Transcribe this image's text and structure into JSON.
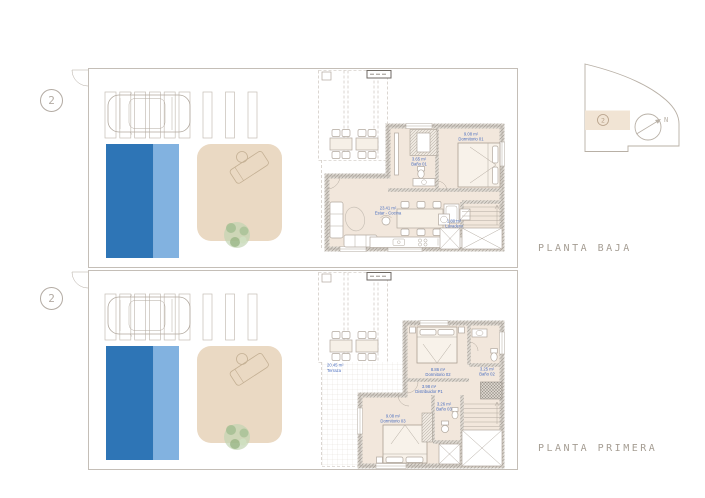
{
  "unit_number": "2",
  "titles": {
    "ground": "PLANTA BAJA",
    "first": "PLANTA PRIMERA"
  },
  "key_plan": {
    "unit_number": "2",
    "north_label": "N"
  },
  "colors": {
    "pool_dark": "#2e75b6",
    "pool_light": "#82b2e0",
    "patio": "#ead9c3",
    "floor": "#f2e7dc",
    "key_highlight": "#f1e4d4",
    "label_blue": "#4b6fc0"
  },
  "gf": {
    "living": {
      "area": "23.41 m²",
      "name": "Estar - Cocina"
    },
    "bath1": {
      "area": "3.65 m²",
      "name": "Baño 01"
    },
    "bedroom1": {
      "area": "9.08 m²",
      "name": "Dormitorio 01"
    },
    "laundry": {
      "area": "1.80 m²",
      "name": "Lavadero"
    }
  },
  "ff": {
    "terrace": {
      "area": "20.45 m²",
      "name": "Terraza"
    },
    "bedroom2": {
      "area": "8.86 m²",
      "name": "Dormitorio 02"
    },
    "bath2": {
      "area": "3.25 m²",
      "name": "Baño 02"
    },
    "hall": {
      "area": "3.98 m²",
      "name": "Distribuidor P1"
    },
    "bedroom3": {
      "area": "9.08 m²",
      "name": "Dormitorio 03"
    },
    "bath3": {
      "area": "3.26 m²",
      "name": "Baño 03"
    }
  }
}
